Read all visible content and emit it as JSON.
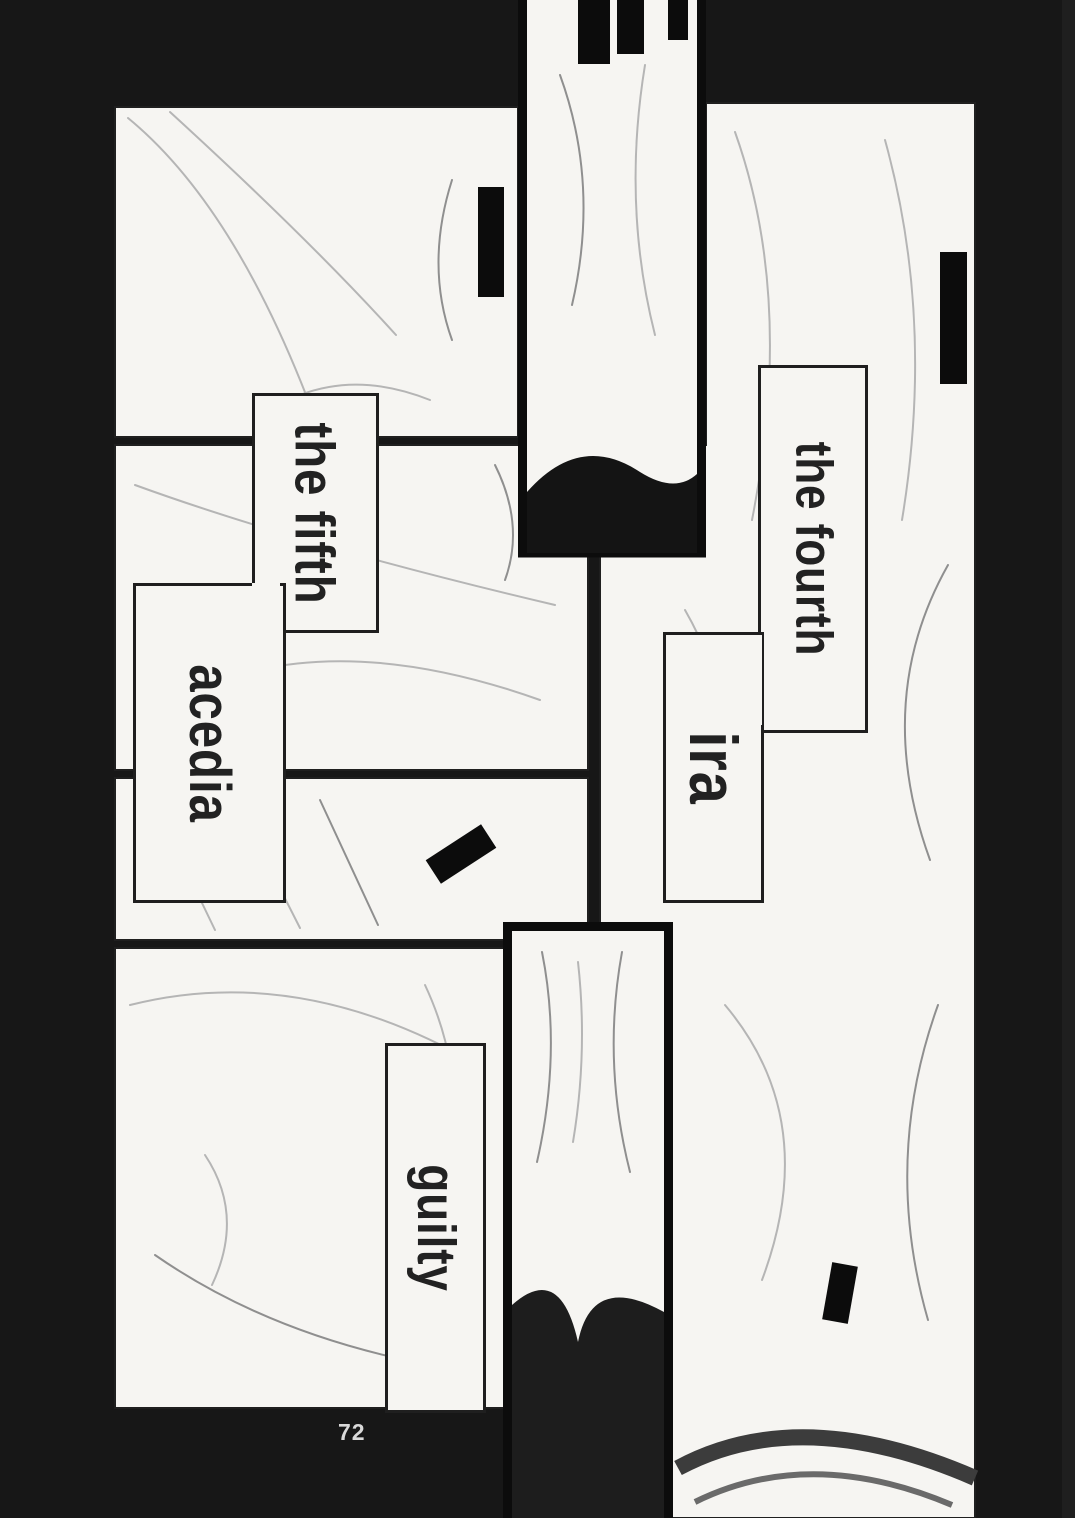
{
  "page": {
    "number": "72",
    "captions": {
      "the_fifth": "the fifth",
      "acedia": "acedia",
      "the_fourth": "the fourth",
      "ira": "ira",
      "guilty": "guilty"
    },
    "colors": {
      "background": "#171717",
      "panel": "#f6f5f2",
      "ink": "#1f1f1f",
      "caption_text": "#222222",
      "censor": "#0c0c0c",
      "page_number_text": "#d9d9d9"
    }
  }
}
